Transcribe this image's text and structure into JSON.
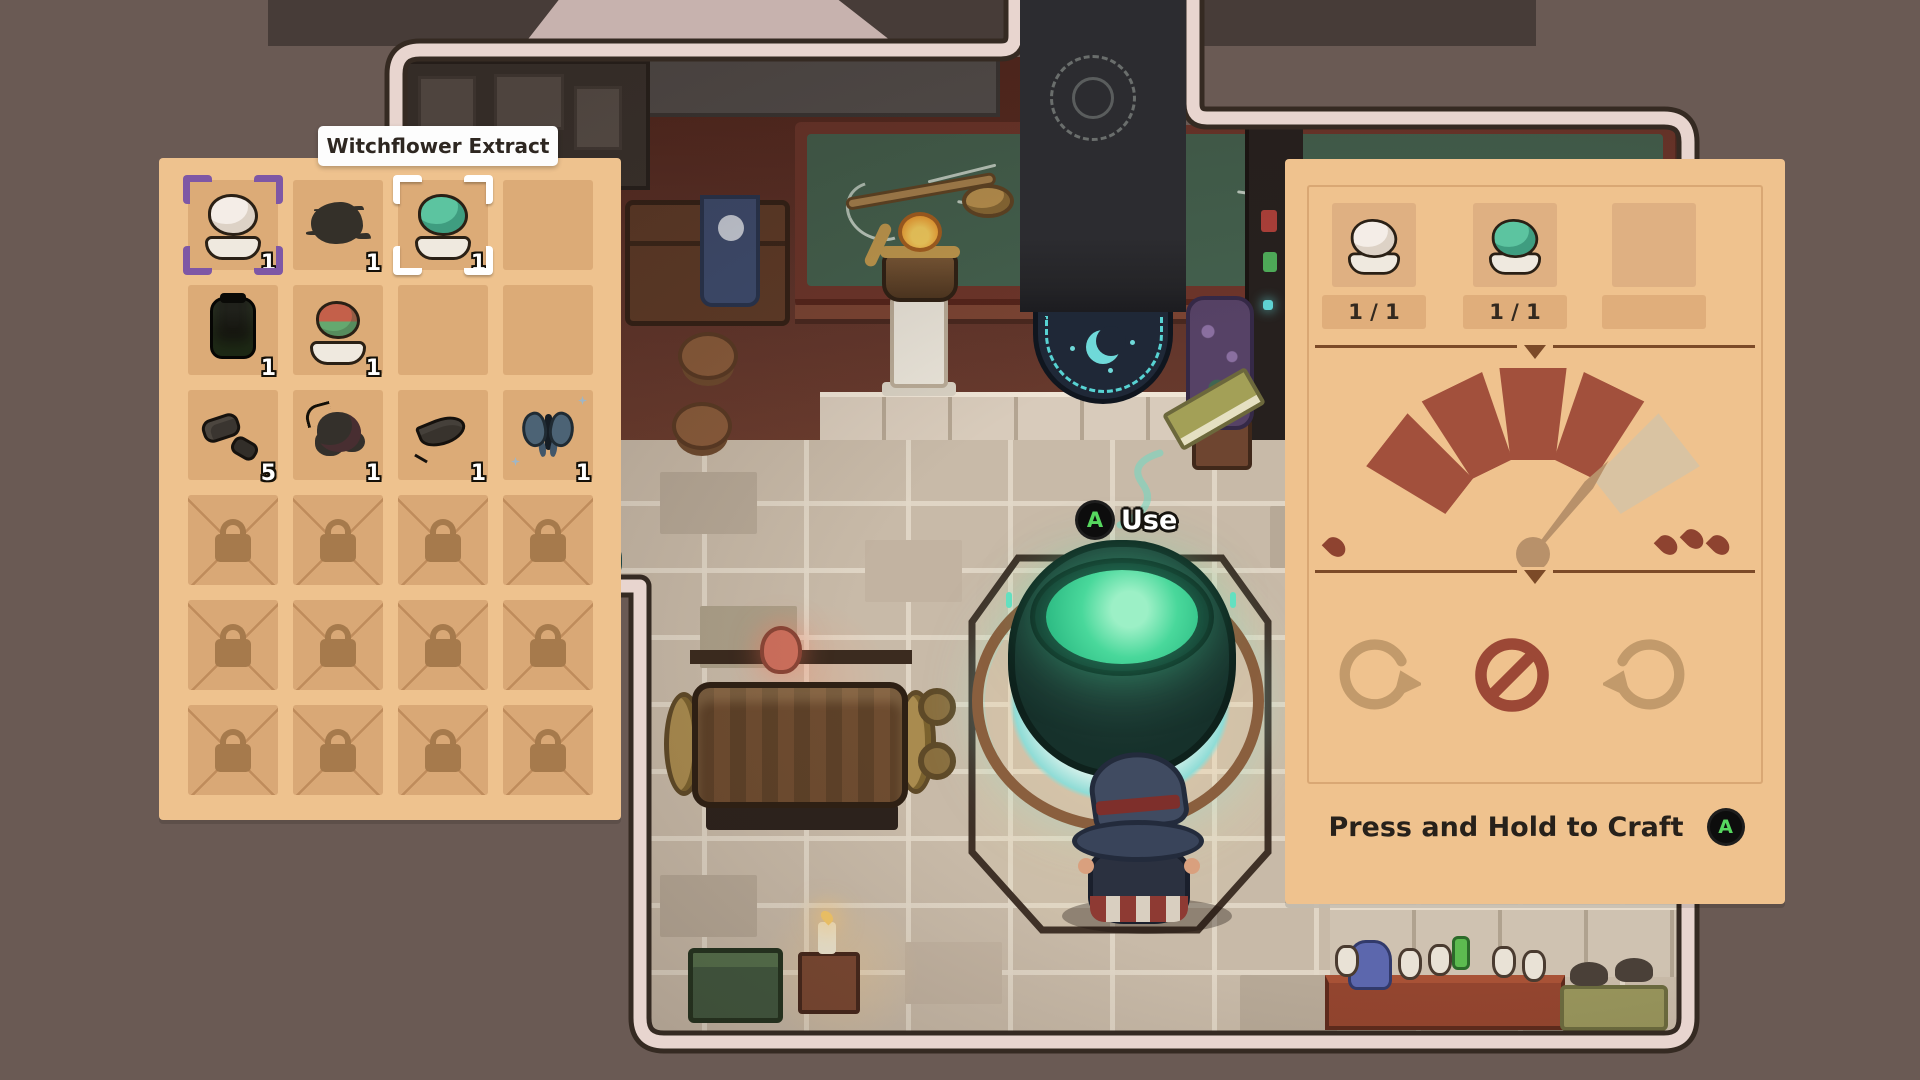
{
  "game": {
    "buttons": {
      "a": "A"
    }
  },
  "tooltip": {
    "text": "Witchflower Extract"
  },
  "inventory": {
    "grid": {
      "rows": 6,
      "cols": 4
    },
    "items": [
      {
        "slot": "r1c1",
        "name": "witchflower-extract",
        "count": "1",
        "cursor": "purple-brackets"
      },
      {
        "slot": "r1c2",
        "name": "black-powder-splat",
        "count": "1"
      },
      {
        "slot": "r1c3",
        "name": "green-herb-dish",
        "count": "1",
        "cursor": "white-brackets"
      },
      {
        "slot": "r2c1",
        "name": "dark-jar",
        "count": "1"
      },
      {
        "slot": "r2c2",
        "name": "red-flower-dish",
        "count": "1"
      },
      {
        "slot": "r3c1",
        "name": "grey-stones",
        "count": "5"
      },
      {
        "slot": "r3c2",
        "name": "dark-berry-cluster",
        "count": "1"
      },
      {
        "slot": "r3c3",
        "name": "dark-leaf",
        "count": "1"
      },
      {
        "slot": "r3c4",
        "name": "blue-butterfly",
        "count": "1"
      }
    ],
    "locked_slot_rows": [
      4,
      5,
      6
    ]
  },
  "crafting": {
    "ingredients": [
      {
        "name": "witchflower-extract",
        "quantity": "1 / 1"
      },
      {
        "name": "green-herb-dish",
        "quantity": "1 / 1"
      },
      {
        "name": "",
        "quantity": ""
      }
    ],
    "heat_gauge": {
      "segments_total": 5,
      "segments_active": 4,
      "needle_between_segments": "4-5",
      "low_flame_count": 1,
      "high_flame_count": 3
    },
    "stir_controls": [
      {
        "name": "stir-clockwise",
        "active": false
      },
      {
        "name": "no-stir",
        "active": true
      },
      {
        "name": "stir-counterclockwise",
        "active": false
      }
    ],
    "craft_prompt": {
      "label": "Press and Hold to Craft",
      "button": "A"
    }
  },
  "scene": {
    "use_prompt": {
      "label": "Use",
      "button": "A"
    }
  },
  "colors": {
    "panel": "#eec28e",
    "slot": "#dcab77",
    "gauge_active": "#a2503c",
    "gauge_inactive": "#d9c3a2",
    "accent_teal": "#5fd5d5",
    "button_green": "#56d75f",
    "cursor_purple": "#7e57a5",
    "room_border": "#e8d5cf"
  }
}
